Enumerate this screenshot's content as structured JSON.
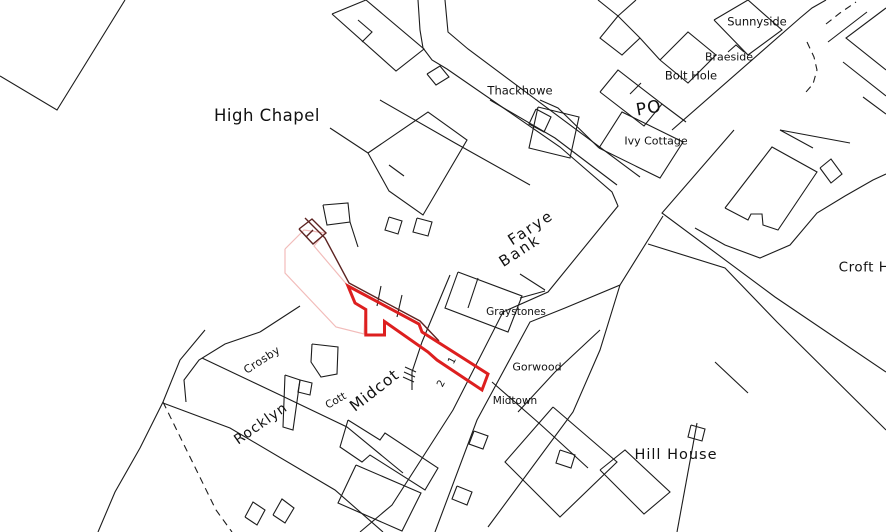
{
  "map": {
    "title": "Cadastral map extract with red-edged property boundary",
    "background_color": "#ffffff",
    "line_color": "#1c1c1c",
    "red_boundary_color": "#dd1f1f",
    "pink_boundary_color": "#f2bcba",
    "maroon_line_color": "#5c2321",
    "labels": [
      {
        "id": "high-chapel",
        "text": "High Chapel",
        "x": 267,
        "y": 116,
        "size": 16.5,
        "rot": 0,
        "ls": 0.5
      },
      {
        "id": "thackhowe",
        "text": "Thackhowe",
        "x": 520,
        "y": 91,
        "size": 11.5,
        "rot": 0,
        "ls": 0
      },
      {
        "id": "sunnyside",
        "text": "Sunnyside",
        "x": 757,
        "y": 22,
        "size": 11.5,
        "rot": 0,
        "ls": 0
      },
      {
        "id": "braeside",
        "text": "Braeside",
        "x": 729,
        "y": 57,
        "size": 11,
        "rot": 0,
        "ls": 0
      },
      {
        "id": "bolt-hole",
        "text": "Bolt Hole",
        "x": 691,
        "y": 76,
        "size": 11.5,
        "rot": 0,
        "ls": 0
      },
      {
        "id": "po",
        "text": "PO",
        "x": 649,
        "y": 109,
        "size": 17,
        "rot": -10,
        "ls": 1
      },
      {
        "id": "ivy-cottage",
        "text": "Ivy Cottage",
        "x": 656,
        "y": 141,
        "size": 11,
        "rot": 0,
        "ls": 0
      },
      {
        "id": "farye",
        "text": "Farye",
        "x": 531,
        "y": 228,
        "size": 15,
        "rot": -33,
        "ls": 2
      },
      {
        "id": "bank",
        "text": "Bank",
        "x": 520,
        "y": 251,
        "size": 15,
        "rot": -33,
        "ls": 2
      },
      {
        "id": "graystones",
        "text": "Graystones",
        "x": 516,
        "y": 312,
        "size": 10.5,
        "rot": 0,
        "ls": 0
      },
      {
        "id": "gorwood",
        "text": "Gorwood",
        "x": 537,
        "y": 367,
        "size": 11,
        "rot": 0,
        "ls": 0
      },
      {
        "id": "midtown",
        "text": "Midtown",
        "x": 515,
        "y": 401,
        "size": 10.5,
        "rot": 0,
        "ls": 0
      },
      {
        "id": "hill-house",
        "text": "Hill House",
        "x": 676,
        "y": 455,
        "size": 14.5,
        "rot": 0,
        "ls": 1
      },
      {
        "id": "croft-h",
        "text": "Croft H",
        "x": 864,
        "y": 268,
        "size": 13.5,
        "rot": 0,
        "ls": 0.5
      },
      {
        "id": "crosby",
        "text": "Crosby",
        "x": 262,
        "y": 360,
        "size": 11,
        "rot": -33,
        "ls": 0.5
      },
      {
        "id": "midcot",
        "text": "Midcot",
        "x": 375,
        "y": 391,
        "size": 15.5,
        "rot": -38,
        "ls": 1
      },
      {
        "id": "cott",
        "text": "Cott",
        "x": 336,
        "y": 401,
        "size": 10.5,
        "rot": -30,
        "ls": 0
      },
      {
        "id": "rocklyn",
        "text": "Rocklyn",
        "x": 261,
        "y": 424,
        "size": 14,
        "rot": -35,
        "ls": 1
      },
      {
        "id": "plot-number-1",
        "text": "1",
        "x": 453,
        "y": 361,
        "size": 10,
        "rot": -63,
        "ls": 0
      },
      {
        "id": "plot-number-2",
        "text": "2",
        "x": 442,
        "y": 384,
        "size": 10,
        "rot": -63,
        "ls": 0
      }
    ],
    "red_boundary_points": "348,286 419,324 422,332 488,374 482,390 437,360 428,352 384.5,321.5 384.5,335 365.8,335 365.8,309.5 355,303",
    "pink_boundary_points": "285,249 304,230 325,233 314,246 331,266 348,286 355,303 365,310 364,334 336,327 285,273",
    "maroon_paths": [
      "299,229 312,219 326,233 313,244 299,229",
      "306,237 313,230",
      "305,218 325,238 349,283 420,321 439,341"
    ],
    "solid_paths": [
      "0,76 57,110 125,0",
      "205,330 180,360 163,402 140,448 115,492 98,532",
      "202,358 278,394 347,427 403,473",
      "163,403 230,428 335,490 383,532",
      "260,332 225,344 199,360 184,380 186,402",
      "260,332 300,306",
      "312,344 338,347 337,374 321,377 311,362 312,344",
      "285,375 300,380 293,430 283,427 285,375",
      "300,380 312,383 310,395 298,392 300,380",
      "245,517 253,502 265,510 257,525 245,517",
      "273,515 282,499 294,508 285,523 273,515",
      "418,0 420,30 423,48 432,60 447,69 560,147 612,192 618,206 548,292 503,312 453,410 392,505 360,532",
      "445,0 448,32 468,49 640,177",
      "672,130 800,18 812,8 826,0",
      "734,130 662,213 775,297 886,372",
      "663,216 620,285 565,308 530,322 477,420 435,532",
      "648,244 725,268 777,322 886,430",
      "620,285 600,350 573,412 488,527",
      "695,228 725,245 760,258 790,245 817,213 845,196 873,180 886,174",
      "725,208 772,147 817,172 778,230 763,225 762,214 751,214 748,220 725,208",
      "820,168 831,159 842,174 831,183 820,168",
      "886,8 846,38 886,70",
      "843,62 886,96",
      "828,42 867,12",
      "863,97 886,114",
      "850,143 780,130 813,148",
      "714,20 748,0 782,30 748,55 714,20",
      "728,52 736,45 744,52",
      "660,60 688,32 716,55 688,83 660,60",
      "598,0 618,16 640,38 660,60",
      "640,38 622,55 600,38 618,16",
      "636,0 618,16",
      "600,92 618,70 662,104 644,126 600,92",
      "630,94 641,83",
      "599,148 622,112 683,142 660,178 599,148",
      "540,100 558,108 599,148",
      "662,104 686,122",
      "536,109 551,117 544,132 529,124 536,109",
      "332,14 366,0 424,49 396,71 332,14",
      "358,20 372,32 362,42",
      "427,74 440,66 449,77 436,85 427,74",
      "368,153 428,112 467,140 423,215 389,191 368,153",
      "389,165 404,176",
      "330,128 368,153",
      "380,100 455,143 530,185",
      "490,100 555,138 617,185",
      "538,107 579,117 570,158 529,148 538,107",
      "458,272 522,296 508,332 445,308 458,272",
      "520,274 545,290",
      "520,298 545,291",
      "518,412 555,372 600,330",
      "450,275 422,342 412,372 412,390",
      "478,278 468,308",
      "381,286 377,306",
      "402,295 397,317",
      "405,367 416,372",
      "404,372 415,377",
      "403,377 414,382",
      "389,217 402,221 398,234 385,230 389,217",
      "417,218 432,222 428,236 413,232 417,218",
      "323,205 348,203 350,222 327,225 323,205",
      "350,222 358,247",
      "348,420 380,440 385,433 438,468 425,490 370,455 362,462 340,447 348,420",
      "356,465 421,493 402,531 338,503 356,465",
      "457,486 472,492 467,505 452,499 457,486",
      "474,431 488,436 483,449 469,444 474,431",
      "553,407 617,462 560,517 505,462 553,407",
      "560,450 575,455 571,468 556,463 560,450",
      "600,470 625,450 670,492 644,514 600,470",
      "715,362 748,393",
      "697,423 677,532",
      "691,425 705,429 702,441 688,437 691,425",
      "492,382 540,424 588,468"
    ],
    "dashed_paths": [
      "163,402 216,510 232,532",
      "807,42 814,57 817,70 813,84 806,92",
      "826,24 840,13 856,2"
    ]
  }
}
